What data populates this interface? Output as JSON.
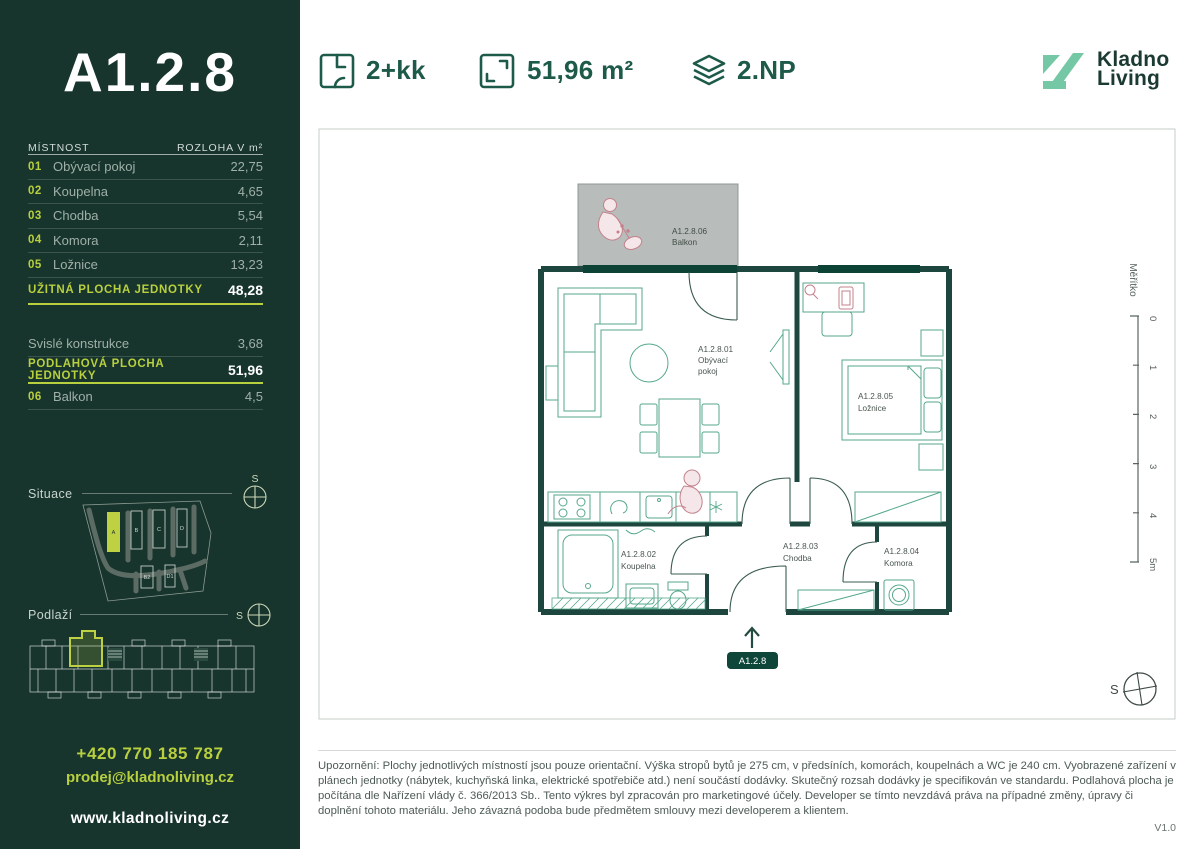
{
  "colors": {
    "sidebar_bg": "#17342d",
    "accent_lime": "#b9d03e",
    "brand_green": "#1d5a49",
    "logo_teal": "#74c8a5",
    "wall": "#1c463e",
    "furniture": "#55a78d",
    "sketch_pink": "#c3818c",
    "balcony_gray": "#b8bcba"
  },
  "unit": {
    "title": "A1.2.8"
  },
  "header": {
    "disposition": "2+kk",
    "area": "51,96 m²",
    "floor": "2.NP",
    "logo_line1": "Kladno",
    "logo_line2": "Living"
  },
  "room_table": {
    "col_room": "MÍSTNOST",
    "col_area": "ROZLOHA V m²",
    "rows": [
      {
        "num": "01",
        "name": "Obývací pokoj",
        "area": "22,75"
      },
      {
        "num": "02",
        "name": "Koupelna",
        "area": "4,65"
      },
      {
        "num": "03",
        "name": "Chodba",
        "area": "5,54"
      },
      {
        "num": "04",
        "name": "Komora",
        "area": "2,11"
      },
      {
        "num": "05",
        "name": "Ložnice",
        "area": "13,23"
      }
    ],
    "usable": {
      "label": "UŽITNÁ PLOCHA JEDNOTKY",
      "value": "48,28"
    },
    "vertical": {
      "label": "Svislé konstrukce",
      "value": "3,68"
    },
    "floor_area": {
      "label": "PODLAHOVÁ PLOCHA JEDNOTKY",
      "value": "51,96"
    },
    "balcony_row": {
      "num": "06",
      "name": "Balkon",
      "value": "4,5"
    }
  },
  "situace": {
    "label": "Situace",
    "compass": "S",
    "buildings": [
      "A",
      "B",
      "C",
      "D",
      "B2",
      "D1"
    ]
  },
  "podlazi": {
    "label": "Podlaží",
    "compass": "S"
  },
  "contact": {
    "phone": "+420 770 185 787",
    "email": "prodej@kladnoliving.cz",
    "web": "www.kladnoliving.cz"
  },
  "plan": {
    "balcony": {
      "id": "A1.2.8.06",
      "name": "Balkon"
    },
    "living": {
      "id": "A1.2.8.01",
      "name_line1": "Obývací",
      "name_line2": "pokoj"
    },
    "bedroom": {
      "id": "A1.2.8.05",
      "name": "Ložnice"
    },
    "bathroom": {
      "id": "A1.2.8.02",
      "name": "Koupelna"
    },
    "hall": {
      "id": "A1.2.8.03",
      "name": "Chodba"
    },
    "storage": {
      "id": "A1.2.8.04",
      "name": "Komora"
    },
    "entrance_badge": "A1.2.8",
    "compass": "S",
    "scale": {
      "label": "Měřítko",
      "ticks": [
        "0",
        "1",
        "2",
        "3",
        "4",
        "5m"
      ]
    }
  },
  "footer": {
    "disclaimer": "Upozornění: Plochy jednotlivých místností jsou pouze orientační. Výška stropů bytů je 275 cm, v předsíních, komorách, koupelnách a WC je 240 cm. Vyobrazené zařízení v plánech jednotky (nábytek, kuchyňská linka, elektrické spotřebiče atd.) není součástí dodávky. Skutečný rozsah dodávky je specifikován ve standardu. Podlahová plocha je počítána dle Nařízení vlády č. 366/2013 Sb.. Tento výkres byl zpracován pro marketingové účely. Developer se tímto nevzdává práva na případné změny, úpravy či doplnění tohoto materiálu. Jeho závazná podoba bude předmětem smlouvy mezi developerem a klientem.",
    "version": "V1.0"
  }
}
